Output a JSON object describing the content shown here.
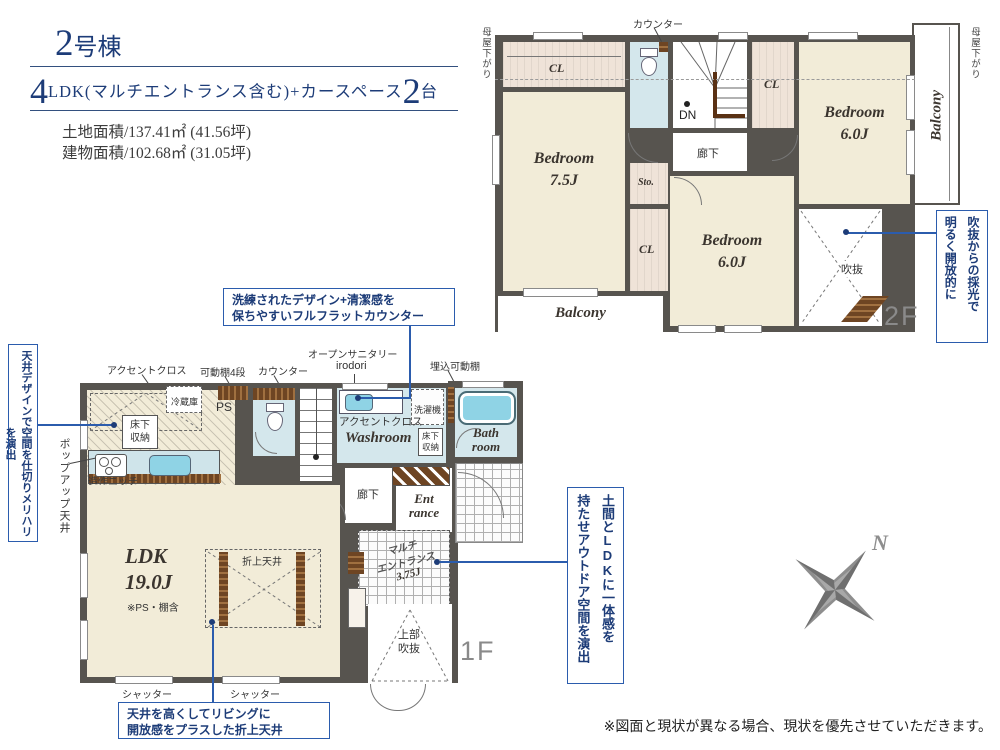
{
  "header": {
    "building_num": "2",
    "building_suffix": "号棟",
    "plan_num1": "4",
    "plan_mid": "LDK(マルチエントランス含む)+カースペース",
    "plan_num2": "2",
    "plan_tail": "台",
    "land_area": "土地面積/137.41㎡ (41.56坪)",
    "building_area": "建物面積/102.68㎡ (31.05坪)"
  },
  "floor2": {
    "label": "2F",
    "moya_left": "母屋下がり",
    "moya_right": "母屋下がり",
    "counter": "カウンター",
    "cl_top": "CL",
    "cl_mid": "CL",
    "cl_low": "CL",
    "dn": "DN",
    "hallway": "廊下",
    "sto": "Sto.",
    "bedroom_a_name": "Bedroom",
    "bedroom_a_size": "6.0J",
    "bedroom_b_name": "Bedroom",
    "bedroom_b_size": "7.5J",
    "bedroom_c_name": "Bedroom",
    "bedroom_c_size": "6.0J",
    "void": "吹抜",
    "balcony_right": "Balcony",
    "balcony_bottom": "Balcony"
  },
  "floor1": {
    "label": "1F",
    "top_labels": {
      "accent": "アクセントクロス",
      "shelf": "可動棚4段",
      "counter": "カウンター",
      "sanitary_line1": "オープンサニタリー",
      "sanitary_line2": "irodori",
      "built_in_shelf": "埋込可動棚"
    },
    "popup_ceiling": "ポップアップ天井",
    "fridge": "冷蔵庫",
    "ps": "PS",
    "floor_storage_kitchen": "床下収納",
    "niche": "造作ニッチ",
    "accent_kitchen": "アクセントクロス",
    "accent_wash": "アクセントクロス",
    "washer": "洗濯機",
    "floor_storage_wash": "床下収納",
    "washroom": "Washroom",
    "bath_line1": "Bath",
    "bath_line2": "room",
    "hallway": "廊下",
    "ent_line1": "Ent",
    "ent_line2": "rance",
    "up": "UP",
    "multi_line1": "マルチ",
    "multi_line2": "エントランス",
    "multi_line3": "3.75J",
    "shelf_side": "可動棚4段",
    "upper_void_line1": "上部",
    "upper_void_line2": "吹抜",
    "ldk_name": "LDK",
    "ldk_size": "19.0J",
    "ldk_note": "※PS・棚含",
    "coffered": "折上天井",
    "shutter1": "シャッター",
    "shutter2": "シャッター"
  },
  "callouts": {
    "ceiling_design": "天井デザインで空間を仕切りメリハリを演出",
    "counter_line1": "洗練されたデザイン+清潔感を",
    "counter_line2": "保ちやすいフルフラットカウンター",
    "doma_line1": "土間とLDKに一体感を",
    "doma_line2": "持たせアウトドア空間を演出",
    "coffered_line1": "天井を高くしてリビングに",
    "coffered_line2": "開放感をプラスした折上天井",
    "void_line1": "吹抜からの採光で",
    "void_line2": "明るく開放的に"
  },
  "compass": {
    "north": "N"
  },
  "disclaimer": "※図面と現状が異なる場合、現状を優先させていただきます。",
  "colors": {
    "navy_text": "#1d3c78",
    "callout_blue": "#2b5cad",
    "wall": "#57544f",
    "room_cream": "#f2ecd8",
    "closet_beige": "#efe3d8",
    "wet_blue": "#d4e7ec",
    "tub_blue": "#8fd3e5",
    "wood_brown": "#6e4523",
    "compass_gray": "#8e8e8e"
  }
}
